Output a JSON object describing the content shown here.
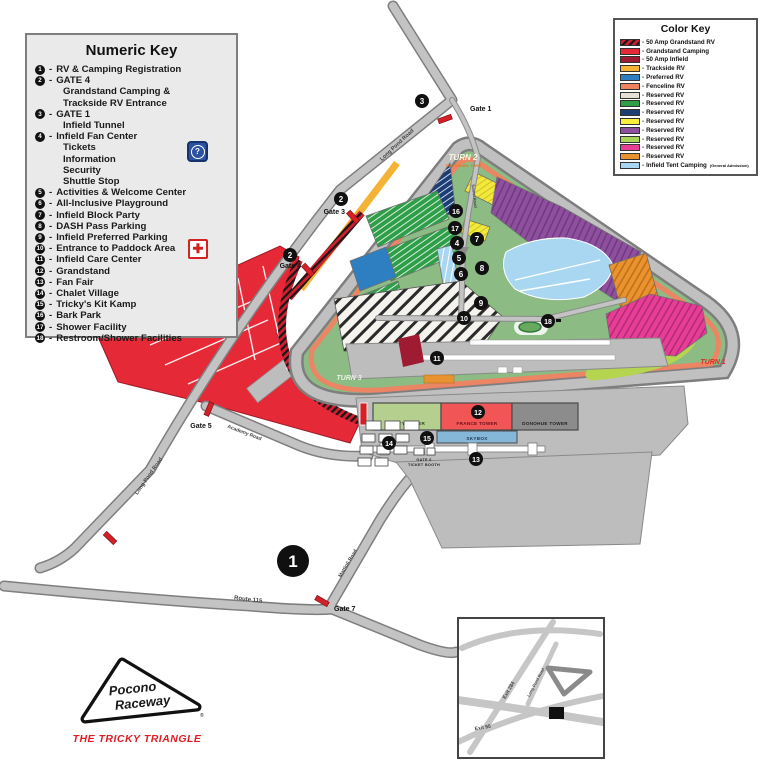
{
  "numeric_key": {
    "title": "Numeric Key",
    "sep": "-",
    "items": [
      {
        "num": "1",
        "label": "RV & Camping Registration"
      },
      {
        "num": "2",
        "label": "GATE 4",
        "sub": [
          "Grandstand Camping &",
          "Trackside RV Entrance"
        ]
      },
      {
        "num": "3",
        "label": "GATE 1",
        "sub": [
          "Infield Tunnel"
        ]
      },
      {
        "num": "4",
        "label": "Infield Fan Center",
        "sub": [
          "Tickets",
          "Information",
          "Security",
          "Shuttle Stop"
        ]
      },
      {
        "num": "5",
        "label": "Activities & Welcome Center"
      },
      {
        "num": "6",
        "label": "All-Inclusive Playground"
      },
      {
        "num": "7",
        "label": "Infield Block Party"
      },
      {
        "num": "8",
        "label": "DASH Pass Parking"
      },
      {
        "num": "9",
        "label": "Infield Preferred Parking"
      },
      {
        "num": "10",
        "label": "Entrance to Paddock Area"
      },
      {
        "num": "11",
        "label": "Infield Care Center"
      },
      {
        "num": "12",
        "label": "Grandstand"
      },
      {
        "num": "13",
        "label": "Fan Fair"
      },
      {
        "num": "14",
        "label": "Chalet Village"
      },
      {
        "num": "15",
        "label": "Tricky's Kit Kamp"
      },
      {
        "num": "16",
        "label": "Bark Park"
      },
      {
        "num": "17",
        "label": "Shower Facility"
      },
      {
        "num": "18",
        "label": "Restroom/Shower Facilities"
      }
    ],
    "icons": {
      "question_glyph": "?",
      "cross_glyph": "✚"
    }
  },
  "color_key": {
    "title": "Color Key",
    "sep": "-",
    "items": [
      {
        "color": "#cf1f2f",
        "hatched": true,
        "label": "50 Amp Grandstand RV"
      },
      {
        "color": "#e62937",
        "label": "Grandstand Camping"
      },
      {
        "color": "#9e1b32",
        "label": "50 Amp Infield"
      },
      {
        "color": "#f5b335",
        "label": "Trackside RV"
      },
      {
        "color": "#2d7fc1",
        "label": "Preferred RV"
      },
      {
        "color": "#f08262",
        "label": "Fenceline RV"
      },
      {
        "color": "#e3e0d5",
        "label": "Reserved RV"
      },
      {
        "color": "#2f9e49",
        "label": "Reserved RV"
      },
      {
        "color": "#1d3d73",
        "label": "Reserved RV"
      },
      {
        "color": "#f7ef3c",
        "label": "Reserved RV"
      },
      {
        "color": "#8f4f9f",
        "label": "Reserved RV"
      },
      {
        "color": "#a8d45a",
        "label": "Reserved RV"
      },
      {
        "color": "#e63e97",
        "label": "Reserved RV"
      },
      {
        "color": "#e89230",
        "label": "Reserved RV"
      },
      {
        "color": "#a9d7f2",
        "label": "Infield Tent Camping",
        "suffix": "(General Admission)"
      }
    ]
  },
  "map": {
    "turn1": "TURN 1",
    "turn2": "TURN 2",
    "turn2_sub": "THE TUNNEL TURN",
    "turn3": "TURN 3",
    "gates": {
      "gate1": "Gate 1",
      "gate3": "Gate 3",
      "gate4": "Gate 4",
      "gate5": "Gate 5",
      "gate7": "Gate 7"
    },
    "roads": {
      "long_pond": "Long Pond Road",
      "route_115": "Route 115",
      "academy": "Academy Road",
      "mattioli": "Mattioli Road",
      "tunnel": "Tunnel Road"
    },
    "buildings": {
      "petty": "PETTY TOWER",
      "france": "FRANCE TOWER",
      "donohue": "DONOHUE TOWER",
      "skybox": "SKYBOX",
      "gate6_line1": "GATE 6",
      "gate6_line2": "TICKET BOOTH"
    },
    "markers": {
      "m1": "1",
      "m2": "2",
      "m3": "3",
      "m4": "4",
      "m5": "5",
      "m6": "6",
      "m7": "7",
      "m8": "8",
      "m9": "9",
      "m10": "10",
      "m11": "11",
      "m12": "12",
      "m13": "13",
      "m14": "14",
      "m15": "15",
      "m16": "16",
      "m17": "17",
      "m18": "18"
    },
    "inset": {
      "exit284": "Exit 284",
      "exit95": "Exit 95",
      "long_pond": "Long Pond Road"
    },
    "logo": {
      "name_line1": "Pocono",
      "name_line2": "Raceway",
      "reg": "®",
      "tagline": "THE TRICKY TRIANGLE"
    }
  }
}
